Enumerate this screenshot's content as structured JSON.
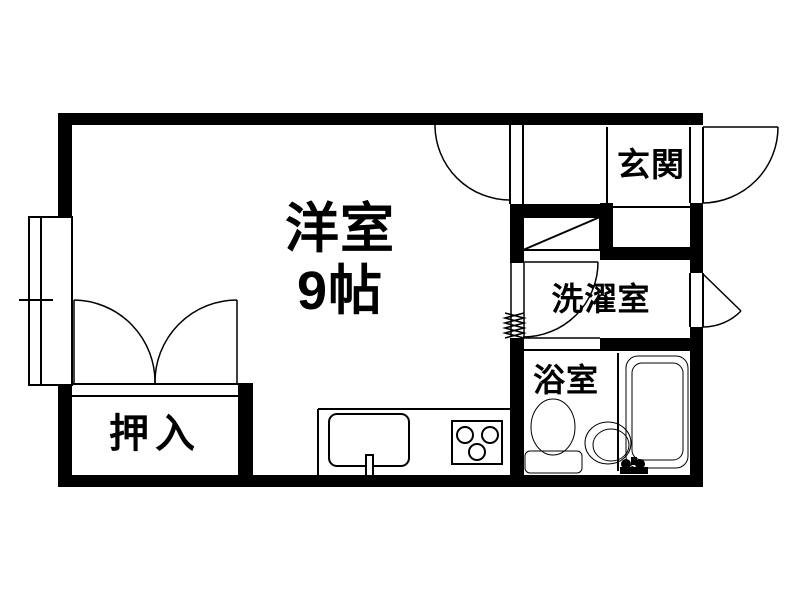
{
  "floor_plan": {
    "background_color": "#ffffff",
    "wall_color": "#000000",
    "line_color": "#000000",
    "rooms": {
      "main_room": {
        "label": "洋室",
        "size_label": "9帖"
      },
      "entrance": {
        "label": "玄関"
      },
      "laundry": {
        "label": "洗濯室"
      },
      "bathroom": {
        "label": "浴室"
      },
      "closet": {
        "label": "押入"
      }
    },
    "fixture_icons": [
      "bathtub-icon",
      "toilet-icon",
      "wash-basin-icon",
      "kitchen-sink-icon",
      "stove-burners-icon",
      "shoe-cabinet-icon",
      "window-icon",
      "door-swing-icon"
    ]
  }
}
